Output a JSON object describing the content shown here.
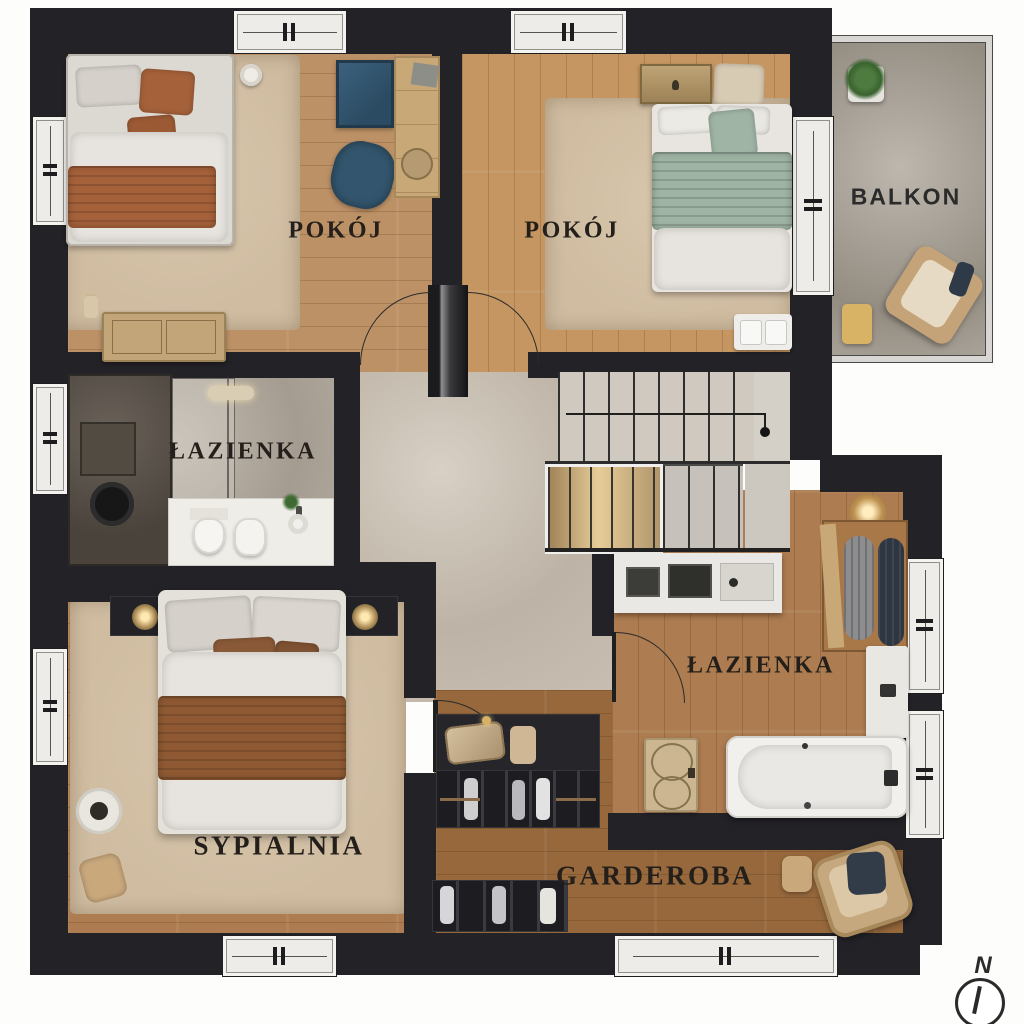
{
  "page": {
    "type": "architectural floor plan rendering (upper storey)"
  },
  "rooms": [
    {
      "id": "pokoj-left",
      "label": "POKÓJ"
    },
    {
      "id": "pokoj-right",
      "label": "POKÓJ"
    },
    {
      "id": "balkon",
      "label": "BALKON"
    },
    {
      "id": "lazienka-top",
      "label": "ŁAZIENKA"
    },
    {
      "id": "sypialnia",
      "label": "SYPIALNIA"
    },
    {
      "id": "lazienka-right",
      "label": "ŁAZIENKA"
    },
    {
      "id": "garderoba",
      "label": "GARDEROBA"
    }
  ],
  "compass": {
    "north_label": "N"
  },
  "colors": {
    "wall": "#232227",
    "wood_light": "#bd9166",
    "wood_golden": "#c59661",
    "wood_mid": "#ad7c50",
    "wood_rich": "#96683c",
    "stone": "#c6bcb1",
    "concrete": "#b2a99d",
    "concrete_dark": "#5a534b",
    "rug": "#cfbca1",
    "fixture_white": "#efede8",
    "bedding_white": "#e7e4df",
    "bedding_gray": "#d5d1ca",
    "rust": "#a5613a",
    "rust_dark": "#8a5a38",
    "sage": "#9fb4a4",
    "navy": "#33566e",
    "brass": "#b3935d",
    "label_ink": "#241f1a"
  }
}
